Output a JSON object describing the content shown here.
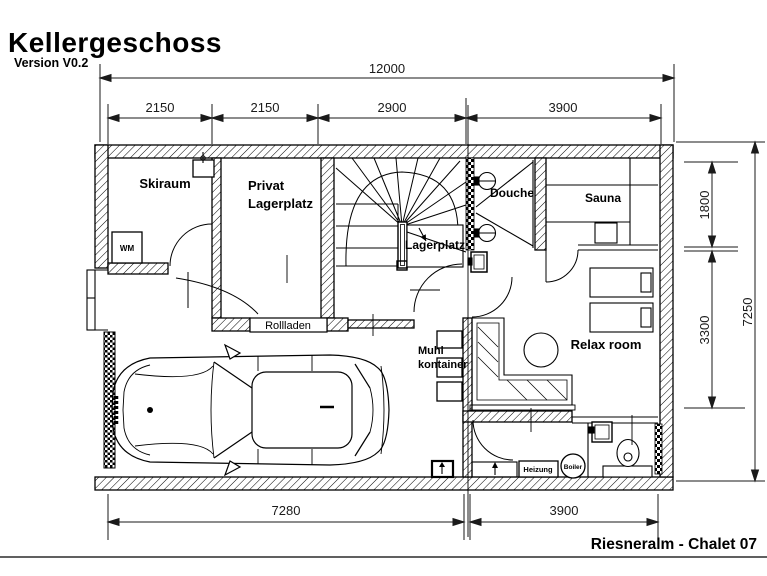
{
  "sheet": {
    "title": "Kellergeschoss",
    "version": "Version V0.2",
    "project": "Riesneralm - Chalet 07"
  },
  "rooms": {
    "skiraum": "Skiraum",
    "privat_line1": "Privat",
    "privat_line2": "Lagerplatz",
    "stair_storage": "Lagerplatz",
    "douche": "Douche",
    "sauna": "Sauna",
    "relax": "Relax room",
    "muhl_line1": "Muhl",
    "muhl_line2": "kontainer",
    "rollladen": "Rollladen",
    "wm": "WM",
    "heizung": "Heizung",
    "boiler": "Boiler"
  },
  "dimensions": {
    "overall_width": "12000",
    "top_segments": [
      "2150",
      "2150",
      "2900",
      "3900"
    ],
    "overall_height": "7250",
    "right_segments": [
      "1800",
      "3300"
    ],
    "bottom_segments": [
      "7280",
      "3900"
    ]
  }
}
